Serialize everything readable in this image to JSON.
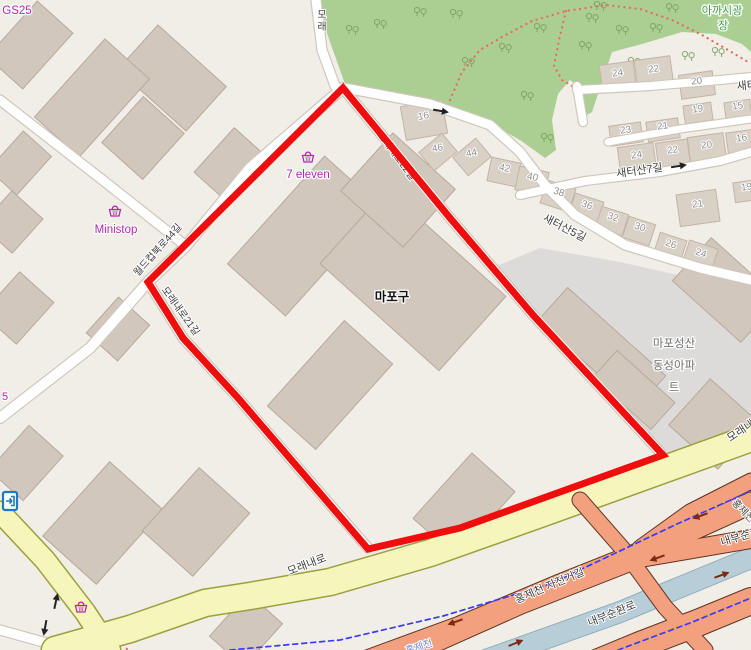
{
  "meta": {
    "app": "web-map-viewer",
    "description": "Map of Mapo-gu block with red highlighted boundary"
  },
  "colors": {
    "land": "#f1eee8",
    "park": "#abce93",
    "tree": "#7da25e",
    "park_path_dots": "#e4705c",
    "gray_area": "#dcdbd9",
    "building_fill": "#d2c7bd",
    "building_stroke": "#b7a99b",
    "house_fill": "#d9d0c6",
    "house_stroke": "#c3b5a6",
    "road_fill": "#ffffff",
    "road_casing": "#cfc7ba",
    "yellow_fill": "#f6f5bb",
    "yellow_casing": "#9aa03c",
    "salmon_fill": "#f2a07e",
    "salmon_casing": "#5f3322",
    "stream_fill": "#b7ced9",
    "stream_casing": "#90aebd",
    "bike_dashed": "#3b3bf0",
    "selection_red": "#ef0d0d",
    "house_number_text": "#8f8f8f",
    "road_text": "#3d3d3d",
    "store_text": "#b327b3",
    "park_text": "#3f9e3f",
    "apartment_text": "#6e6e6e",
    "entrance_icon_blue": "#1f7ac6",
    "highway_arrow": "#7d2a13",
    "oneway_arrow": "#222222",
    "water_text": "#7186d8"
  },
  "park": {
    "outline": [
      316,
      0,
      330,
      42,
      345,
      84,
      420,
      100,
      480,
      118,
      520,
      140,
      545,
      158,
      556,
      150,
      552,
      120,
      558,
      94,
      570,
      80,
      583,
      90,
      582,
      118,
      592,
      112,
      612,
      52,
      642,
      44,
      682,
      32,
      716,
      34,
      742,
      44,
      751,
      52,
      751,
      0
    ],
    "trees": [
      [
        352,
        30
      ],
      [
        380,
        24
      ],
      [
        420,
        12
      ],
      [
        456,
        14
      ],
      [
        505,
        48
      ],
      [
        468,
        62
      ],
      [
        540,
        28
      ],
      [
        592,
        18
      ],
      [
        622,
        30
      ],
      [
        656,
        28
      ],
      [
        688,
        56
      ],
      [
        634,
        62
      ],
      [
        718,
        52
      ],
      [
        585,
        46
      ],
      [
        527,
        96
      ],
      [
        547,
        138
      ],
      [
        600,
        6
      ],
      [
        672,
        8
      ]
    ],
    "dotted_paths": [
      [
        450,
        100,
        462,
        72,
        480,
        50,
        502,
        37,
        532,
        21,
        566,
        11,
        606,
        5,
        640,
        9,
        672,
        20,
        702,
        35,
        728,
        50,
        748,
        62
      ],
      [
        566,
        11,
        559,
        40,
        554,
        66,
        562,
        80,
        572,
        86
      ],
      [
        114,
        638,
        121,
        643,
        127,
        649
      ]
    ]
  },
  "gray_area": [
    492,
    268,
    540,
    248,
    620,
    262,
    700,
    280,
    751,
    292,
    751,
    425,
    700,
    442,
    663,
    455,
    600,
    390,
    533,
    315
  ],
  "buildings": [
    [
      30,
      45,
      75,
      48,
      -48
    ],
    [
      172,
      78,
      60,
      92,
      -48
    ],
    [
      92,
      98,
      105,
      60,
      -48
    ],
    [
      143,
      138,
      62,
      55,
      -48
    ],
    [
      20,
      163,
      52,
      38,
      -48
    ],
    [
      12,
      222,
      46,
      42,
      -48
    ],
    [
      18,
      308,
      56,
      46,
      -48
    ],
    [
      118,
      329,
      48,
      42,
      -48
    ],
    [
      232,
      166,
      60,
      48,
      -48
    ],
    [
      305,
      236,
      145,
      78,
      -48
    ],
    [
      413,
      280,
      100,
      160,
      -48
    ],
    [
      330,
      385,
      115,
      65,
      -48
    ],
    [
      464,
      505,
      88,
      58,
      -48
    ],
    [
      398,
      190,
      78,
      84,
      -48
    ],
    [
      26,
      463,
      60,
      46,
      -48
    ],
    [
      103,
      523,
      100,
      72,
      -48
    ],
    [
      196,
      522,
      85,
      68,
      -48
    ],
    [
      246,
      630,
      58,
      46,
      -48
    ],
    [
      602,
      348,
      44,
      132,
      -48
    ],
    [
      634,
      390,
      36,
      78,
      -48
    ],
    [
      726,
      290,
      58,
      92,
      -48
    ],
    [
      714,
      424,
      62,
      66,
      -48
    ]
  ],
  "houses": [
    {
      "n": "16",
      "x": 424,
      "y": 116,
      "rot": -10,
      "w": 42,
      "h": 34
    },
    {
      "n": "46",
      "x": 438,
      "y": 148,
      "rot": -40,
      "w": 30,
      "h": 24
    },
    {
      "n": "44",
      "x": 472,
      "y": 153,
      "rot": -40,
      "w": 30,
      "h": 24
    },
    {
      "n": "42",
      "x": 504,
      "y": 168,
      "rot": 12,
      "w": 30,
      "h": 24
    },
    {
      "n": "40",
      "x": 532,
      "y": 177,
      "rot": 12,
      "w": 30,
      "h": 24
    },
    {
      "n": "38",
      "x": 558,
      "y": 192,
      "rot": 18,
      "w": 30,
      "h": 24
    },
    {
      "n": "36",
      "x": 586,
      "y": 205,
      "rot": 18,
      "w": 30,
      "h": 24
    },
    {
      "n": "32",
      "x": 612,
      "y": 217,
      "rot": 18,
      "w": 28,
      "h": 22
    },
    {
      "n": "30",
      "x": 639,
      "y": 227,
      "rot": 18,
      "w": 28,
      "h": 22
    },
    {
      "n": "26",
      "x": 670,
      "y": 244,
      "rot": 18,
      "w": 28,
      "h": 24
    },
    {
      "n": "24",
      "x": 700,
      "y": 253,
      "rot": 18,
      "w": 30,
      "h": 26
    },
    {
      "n": "24",
      "x": 618,
      "y": 73,
      "rot": -8,
      "w": 34,
      "h": 28
    },
    {
      "n": "22",
      "x": 654,
      "y": 69,
      "rot": -8,
      "w": 36,
      "h": 30
    },
    {
      "n": "20",
      "x": 697,
      "y": 81,
      "rot": -8,
      "w": 34,
      "h": 24
    },
    {
      "n": "19",
      "x": 698,
      "y": 109,
      "rot": -8,
      "w": 28,
      "h": 18
    },
    {
      "n": "15",
      "x": 738,
      "y": 106,
      "rot": -8,
      "w": 26,
      "h": 18
    },
    {
      "n": "23",
      "x": 626,
      "y": 130,
      "rot": -8,
      "w": 32,
      "h": 20
    },
    {
      "n": "21",
      "x": 663,
      "y": 126,
      "rot": -8,
      "w": 32,
      "h": 20
    },
    {
      "n": "24",
      "x": 637,
      "y": 155,
      "rot": -8,
      "w": 36,
      "h": 28
    },
    {
      "n": "22",
      "x": 673,
      "y": 150,
      "rot": -8,
      "w": 32,
      "h": 26
    },
    {
      "n": "20",
      "x": 707,
      "y": 145,
      "rot": -8,
      "w": 36,
      "h": 28
    },
    {
      "n": "16",
      "x": 742,
      "y": 138,
      "rot": -8,
      "w": 30,
      "h": 22
    },
    {
      "n": "21",
      "x": 698,
      "y": 204,
      "rot": -8,
      "w": 40,
      "h": 32
    },
    {
      "n": "19",
      "x": 747,
      "y": 187,
      "rot": -8,
      "w": 26,
      "h": 20
    }
  ],
  "roads_white": [
    {
      "name": "ministop-road",
      "pts": [
        0,
        100,
        100,
        178,
        186,
        246
      ],
      "w": 9
    },
    {
      "name": "worldcup-bukro",
      "pts": [
        343,
        88,
        250,
        168,
        186,
        246,
        148,
        282,
        90,
        348,
        0,
        418
      ],
      "w": 10
    },
    {
      "name": "moraenae-ro-21",
      "pts": [
        148,
        282,
        183,
        338,
        238,
        398,
        300,
        470,
        368,
        548
      ],
      "w": 9
    },
    {
      "name": "moraenae-ro-22",
      "pts": [
        343,
        88,
        450,
        218,
        533,
        315,
        610,
        398,
        660,
        452
      ],
      "w": 9
    },
    {
      "name": "north-stub",
      "pts": [
        335,
        86,
        322,
        50,
        316,
        0
      ],
      "w": 9
    },
    {
      "name": "park-edge-saeteosan5",
      "pts": [
        345,
        88,
        430,
        104,
        490,
        125,
        520,
        152,
        545,
        185,
        575,
        215,
        625,
        245,
        700,
        268,
        751,
        280
      ],
      "w": 9
    },
    {
      "name": "saeteosan-top",
      "pts": [
        577,
        90,
        650,
        86,
        720,
        80,
        751,
        77
      ],
      "w": 8
    },
    {
      "name": "saeteosan-7",
      "pts": [
        520,
        195,
        585,
        181,
        660,
        172,
        720,
        161,
        751,
        152
      ],
      "w": 8
    },
    {
      "name": "saeteosan-lane",
      "pts": [
        608,
        142,
        680,
        129,
        751,
        119
      ],
      "w": 7
    },
    {
      "name": "park-spur",
      "pts": [
        577,
        86,
        583,
        122
      ],
      "w": 8
    },
    {
      "name": "bottom-left-road",
      "pts": [
        0,
        630,
        50,
        644,
        78,
        652
      ],
      "w": 9
    }
  ],
  "roads_yellow": [
    {
      "name": "moraenae-ro",
      "pts": [
        751,
        438,
        640,
        478,
        540,
        514,
        430,
        553,
        330,
        582,
        250,
        596,
        205,
        603,
        130,
        629,
        55,
        650
      ],
      "w": 26
    },
    {
      "name": "moraenae-ro-branch",
      "pts": [
        0,
        512,
        45,
        560,
        85,
        612,
        110,
        650
      ],
      "w": 20
    }
  ],
  "stream": {
    "name": "hongjecheon-stream",
    "pts": [
      751,
      558,
      620,
      612,
      480,
      662
    ],
    "w": 20
  },
  "roads_salmon": [
    {
      "name": "ramp-ne",
      "pts": [
        751,
        481,
        690,
        512,
        640,
        548
      ],
      "w": 15
    },
    {
      "name": "ramp-from-moraenae",
      "pts": [
        580,
        500,
        622,
        548,
        665,
        607,
        705,
        650
      ],
      "w": 15
    },
    {
      "name": "naebu-upper-a",
      "pts": [
        370,
        660,
        460,
        627,
        560,
        585,
        650,
        549,
        751,
        503
      ],
      "w": 21
    },
    {
      "name": "naebu-upper-b",
      "pts": [
        408,
        655,
        520,
        605,
        640,
        558,
        751,
        539
      ],
      "w": 18
    },
    {
      "name": "naebu-lower",
      "pts": [
        560,
        678,
        640,
        645,
        700,
        622,
        751,
        601
      ],
      "w": 26
    }
  ],
  "bike_dashed": [
    [
      230,
      650,
      340,
      640,
      443,
      616,
      550,
      584,
      677,
      524,
      751,
      491
    ],
    [
      618,
      650,
      690,
      623,
      751,
      598
    ]
  ],
  "selection_outline": {
    "points": [
      343,
      88,
      450,
      218,
      533,
      315,
      610,
      398,
      663,
      455,
      560,
      492,
      460,
      528,
      368,
      549,
      300,
      470,
      238,
      398,
      183,
      338,
      148,
      282
    ],
    "width": 7
  },
  "road_labels_under_red": [
    {
      "t": "모래내로22길",
      "x": 394,
      "y": 158,
      "r": 53,
      "s": 10
    },
    {
      "t": "월드컵북로44길",
      "x": 160,
      "y": 252,
      "r": -48,
      "s": 10
    }
  ],
  "road_labels": [
    {
      "t": "모래내로21길",
      "x": 178,
      "y": 313,
      "r": 54,
      "s": 10
    },
    {
      "t": "새터산7길",
      "x": 640,
      "y": 174,
      "r": -8,
      "s": 11
    },
    {
      "t": "새터산5길",
      "x": 563,
      "y": 231,
      "r": 27,
      "s": 11
    },
    {
      "t": "새터산",
      "x": 737,
      "y": 90,
      "r": -5,
      "s": 11,
      "a": "s"
    },
    {
      "t": "모래내로",
      "x": 308,
      "y": 568,
      "r": -21,
      "s": 11
    },
    {
      "t": "모래내로",
      "x": 730,
      "y": 442,
      "r": -33,
      "s": 11,
      "a": "s"
    },
    {
      "t": "내부순환로",
      "x": 613,
      "y": 617,
      "r": -22,
      "s": 11
    },
    {
      "t": "내부순환로",
      "x": 722,
      "y": 546,
      "r": -17,
      "s": 11,
      "a": "s"
    },
    {
      "t": "홍제천 자전거길",
      "x": 551,
      "y": 589,
      "r": -23,
      "s": 11
    },
    {
      "t": "홍제천",
      "x": 741,
      "y": 513,
      "r": 46,
      "s": 10
    },
    {
      "t": "홍제천",
      "x": 420,
      "y": 650,
      "r": -18,
      "s": 10,
      "c": "#7186d8"
    },
    {
      "t": "모래",
      "x": 322,
      "y": 10,
      "v": 1,
      "s": 10
    }
  ],
  "area_labels": [
    {
      "t": "마포구",
      "x": 392,
      "y": 301,
      "s": 12.5,
      "c": "#111111",
      "b": 1,
      "name": "district-label"
    },
    {
      "t": "마포성산",
      "x": 674,
      "y": 347,
      "s": 11.5,
      "c": "#6e6e6e",
      "name": "apartment-label"
    },
    {
      "t": "동성아파",
      "x": 674,
      "y": 369,
      "s": 11.5,
      "c": "#6e6e6e",
      "name": "apartment-label"
    },
    {
      "t": "트",
      "x": 674,
      "y": 391,
      "s": 11.5,
      "c": "#6e6e6e",
      "name": "apartment-label"
    },
    {
      "t": "아까시광",
      "x": 722,
      "y": 14,
      "s": 11,
      "c": "#3f9e3f",
      "name": "park-name-label"
    },
    {
      "t": "장",
      "x": 723,
      "y": 29,
      "s": 11,
      "c": "#3f9e3f",
      "name": "park-name-label"
    },
    {
      "t": "5",
      "x": 5,
      "y": 400,
      "s": 11,
      "c": "#b327b3",
      "name": "store-label-partial"
    }
  ],
  "poi_labels": [
    {
      "t": "GS25",
      "x": 17,
      "y": 14,
      "name": "gs25-store-label"
    },
    {
      "t": "Ministop",
      "x": 116,
      "y": 233,
      "name": "ministop-store-label"
    },
    {
      "t": "7 eleven",
      "x": 308,
      "y": 178,
      "name": "seven-eleven-store-label"
    }
  ],
  "basket_icons": [
    [
      115,
      211
    ],
    [
      308,
      157
    ],
    [
      81,
      607
    ]
  ],
  "entrance_icon": {
    "x": 10,
    "y": 501
  },
  "oneway_arrows": [
    {
      "x": 441,
      "y": 111,
      "r": 10
    },
    {
      "x": 679,
      "y": 166,
      "r": -9
    },
    {
      "x": 56,
      "y": 601,
      "r": -78
    },
    {
      "x": 45,
      "y": 628,
      "r": 100
    }
  ],
  "highway_arrows": [
    {
      "x": 700,
      "y": 516,
      "r": 160
    },
    {
      "x": 657,
      "y": 558,
      "r": 160
    },
    {
      "x": 722,
      "y": 575,
      "r": -20
    },
    {
      "x": 516,
      "y": 643,
      "r": -22
    },
    {
      "x": 455,
      "y": 622,
      "r": 160
    }
  ]
}
